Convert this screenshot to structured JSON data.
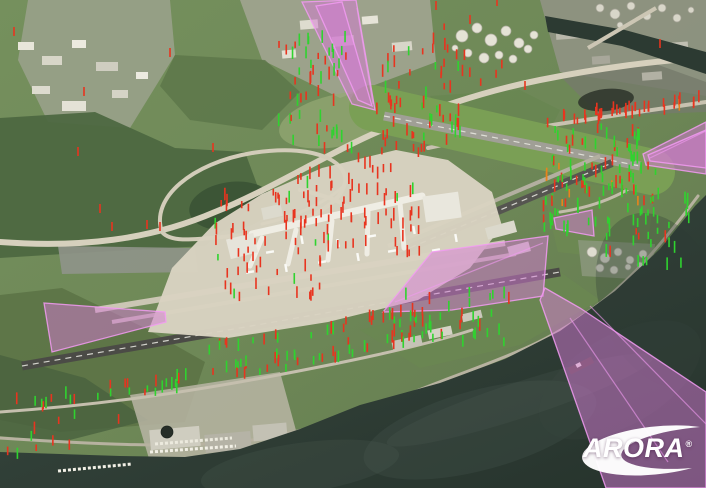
{
  "logo": {
    "text": "ARORA",
    "registered": "®"
  },
  "colors": {
    "surface_fill": "#d67ad6",
    "surface_edge": "#f29bf2",
    "marker_red": "#e8341f",
    "marker_green": "#2fd32f",
    "marker_orange": "#e8831c",
    "water_deep": "#26332c",
    "water_shallow": "#3a4a41",
    "land_green": "#6e8857",
    "runway_dark": "#4b4b46",
    "taxiway_light": "#cbc6b4",
    "apron_tan": "#d9d3c1",
    "logo_white": "#ffffff"
  },
  "map": {
    "patches": [
      {
        "pts": "28,0 170,0 175,55 130,128 48,122 18,60",
        "f": "#99a189",
        "o": 0.9
      },
      {
        "pts": "240,0 430,0 436,62 340,98 262,60",
        "f": "#a3a694",
        "o": 0.85
      },
      {
        "pts": "540,0 706,0 706,96 560,72",
        "f": "#8e9282",
        "o": 0.95
      },
      {
        "pts": "0,118 95,112 175,148 245,152 262,198 205,246 95,252 0,258",
        "f": "#4d6841",
        "o": 0.95
      },
      {
        "pts": "175,55 265,60 300,92 262,130 190,120 160,86",
        "f": "#5b7549",
        "o": 0.8
      },
      {
        "el": [
          231,
          206,
          42,
          24,
          -8
        ],
        "f": "#3a5335",
        "o": 0.9
      },
      {
        "el": [
          340,
          120,
          62,
          26,
          -12
        ],
        "f": "#96a975",
        "o": 0.7
      },
      {
        "pts": "0,295 62,288 145,328 205,362 185,422 60,432 0,420",
        "f": "#5c7346",
        "o": 0.9
      },
      {
        "pts": "0,355 85,378 148,420 62,442 0,436",
        "f": "#49613e",
        "o": 0.8
      },
      {
        "pts": "540,178 655,192 645,262 558,252",
        "f": "#6d8a52",
        "o": 0.75
      },
      {
        "pts": "430,96 520,90 560,110 540,150 460,150",
        "f": "#66854e",
        "o": 0.6
      },
      {
        "pts": "560,76 650,62 706,82 706,112 600,116",
        "f": "#757a6b",
        "o": 0.8
      },
      {
        "el": [
          606,
          100,
          28,
          11,
          -6
        ],
        "f": "#31372e",
        "o": 0.9
      },
      {
        "pts": "360,330 480,300 560,272 600,300 520,345 420,368",
        "f": "#6a8751",
        "o": 0.8
      },
      {
        "pts": "58,246 195,248 198,272 62,274",
        "f": "#8f948a",
        "o": 0.9
      },
      {
        "pts": "130,395 280,372 300,445 150,462",
        "f": "#b9b5a4",
        "o": 0.85
      },
      {
        "pts": "578,240 655,244 652,280 582,276",
        "f": "#8d9880",
        "o": 0.8
      }
    ],
    "roads": [
      {
        "d": "M0,242 C80,248 150,240 215,212 C270,190 330,152 382,130 C430,110 480,92 540,80 C600,68 660,60 706,58",
        "w": 6,
        "c": "#d6d0bd"
      },
      {
        "d": "M162,232 C150,198 192,163 252,153 C322,142 352,166 344,186 C336,212 282,232 222,237 C190,240 170,242 162,232",
        "w": 4,
        "c": "#d2ccb9"
      },
      {
        "d": "M344,186 C326,202 298,216 262,224",
        "w": 3,
        "c": "#cfc9b6"
      },
      {
        "d": "M428,148 C520,128 600,118 706,102",
        "w": 4,
        "c": "#c8c2b0"
      },
      {
        "d": "M0,438 C90,444 185,449 252,440 C330,428 382,404 442,381 C505,357 545,344 588,312 C628,284 662,244 698,196",
        "w": 3,
        "c": "#b7b2a0"
      },
      {
        "d": "M0,412 C100,405 180,393 262,378 C342,363 420,347 472,330",
        "w": 3,
        "c": "#c5bfae"
      },
      {
        "d": "M560,212 C600,206 636,190 650,170 C660,153 646,144 626,149",
        "w": 3,
        "c": "#c2bcaa"
      },
      {
        "d": "M300,190 C330,196 352,206 364,218",
        "w": 4,
        "c": "#d2ccb9"
      }
    ],
    "runways": [
      {
        "x1": 372,
        "y1": 108,
        "x2": 652,
        "y2": 172,
        "w": 46,
        "c": "#7a9f55",
        "cap": "round"
      },
      {
        "x1": 384,
        "y1": 116,
        "x2": 640,
        "y2": 166,
        "w": 9,
        "c": "#a09f96",
        "dash": true
      },
      {
        "x1": 388,
        "y1": 246,
        "x2": 600,
        "y2": 156,
        "w": 4,
        "c": "#b3afa0"
      },
      {
        "x1": 400,
        "y1": 252,
        "x2": 612,
        "y2": 163,
        "w": 8,
        "c": "#555550",
        "dash": true
      },
      {
        "x1": 95,
        "y1": 310,
        "x2": 505,
        "y2": 243,
        "w": 6,
        "c": "#cbc6b4"
      },
      {
        "x1": 112,
        "y1": 322,
        "x2": 516,
        "y2": 254,
        "w": 4,
        "c": "#c1bcaa"
      },
      {
        "x1": 22,
        "y1": 366,
        "x2": 560,
        "y2": 272,
        "w": 9,
        "c": "#4b4b46",
        "dash": true
      }
    ],
    "apron": {
      "pts": "148,332 172,268 214,224 262,194 322,168 396,150 448,160 492,192 502,226 470,268 418,300 328,322 228,338",
      "f": "#d9d3c1",
      "o": 0.97
    },
    "concourses": [
      {
        "d": "M252,234 L422,196",
        "w": 7,
        "c": "#efede4"
      },
      {
        "d": "M262,238 L250,266",
        "w": 5,
        "c": "#efede4"
      },
      {
        "d": "M296,230 L288,264",
        "w": 5,
        "c": "#efede4"
      },
      {
        "d": "M332,221 L328,260",
        "w": 5,
        "c": "#efede4"
      },
      {
        "d": "M368,211 L367,254",
        "w": 5,
        "c": "#efede4"
      },
      {
        "d": "M400,203 L404,248",
        "w": 5,
        "c": "#efede4"
      }
    ],
    "buildings": [
      [
        18,
        42,
        16,
        8,
        0,
        "#e8e6da"
      ],
      [
        42,
        56,
        20,
        9,
        0,
        "#d8d6c8"
      ],
      [
        72,
        40,
        14,
        8,
        0,
        "#eceadf"
      ],
      [
        96,
        62,
        22,
        9,
        0,
        "#cfcdc0"
      ],
      [
        32,
        86,
        18,
        8,
        0,
        "#dddbcf"
      ],
      [
        62,
        101,
        24,
        10,
        0,
        "#e4e2d6"
      ],
      [
        112,
        90,
        16,
        8,
        0,
        "#d5d3c6"
      ],
      [
        136,
        72,
        12,
        7,
        0,
        "#eceae0"
      ],
      [
        300,
        20,
        18,
        9,
        -5,
        "#dedccf"
      ],
      [
        332,
        36,
        22,
        10,
        -5,
        "#cfcdc0"
      ],
      [
        362,
        16,
        16,
        8,
        -5,
        "#e6e4d8"
      ],
      [
        392,
        42,
        20,
        9,
        -5,
        "#d8d6c9"
      ],
      [
        282,
        50,
        14,
        8,
        -5,
        "#e2e0d3"
      ],
      [
        556,
        30,
        24,
        9,
        -4,
        "#b9b8ab"
      ],
      [
        592,
        56,
        18,
        8,
        -4,
        "#a8a79a"
      ],
      [
        642,
        72,
        20,
        8,
        -4,
        "#b2b1a4"
      ],
      [
        672,
        42,
        16,
        8,
        -4,
        "#c0bfb2"
      ],
      [
        150,
        428,
        50,
        20,
        -5,
        "#cfcdc0"
      ],
      [
        205,
        433,
        46,
        18,
        -5,
        "#b5b3a6"
      ],
      [
        253,
        424,
        34,
        16,
        -5,
        "#c3c1b4"
      ],
      [
        392,
        338,
        30,
        10,
        -12,
        "#c5c3b6"
      ],
      [
        428,
        328,
        24,
        9,
        -12,
        "#d5d3c6"
      ],
      [
        462,
        312,
        20,
        8,
        -14,
        "#cac8bb"
      ],
      [
        486,
        224,
        30,
        12,
        -15,
        "#dbd9cc"
      ],
      [
        508,
        244,
        22,
        10,
        -15,
        "#cfcdc0"
      ],
      [
        424,
        194,
        36,
        26,
        -8,
        "#e9e7dd"
      ],
      [
        228,
        236,
        28,
        20,
        -14,
        "#e6e4da"
      ],
      [
        262,
        206,
        20,
        12,
        -12,
        "#dcdacd"
      ]
    ],
    "tanks": [
      {
        "f": "#e5e3d6",
        "s": "#b0aea0",
        "circles": [
          [
            462,
            36,
            6
          ],
          [
            477,
            28,
            5
          ],
          [
            491,
            40,
            6
          ],
          [
            506,
            31,
            5
          ],
          [
            519,
            43,
            5
          ],
          [
            468,
            53,
            4
          ],
          [
            484,
            58,
            5
          ],
          [
            499,
            55,
            4
          ],
          [
            513,
            59,
            4
          ],
          [
            528,
            49,
            4
          ],
          [
            455,
            48,
            3
          ],
          [
            534,
            35,
            4
          ]
        ]
      },
      {
        "f": "#d8d6c9",
        "s": "#a5a396",
        "circles": [
          [
            600,
            8,
            4
          ],
          [
            615,
            14,
            5
          ],
          [
            631,
            6,
            4
          ],
          [
            647,
            16,
            4
          ],
          [
            662,
            8,
            4
          ],
          [
            677,
            18,
            4
          ],
          [
            691,
            10,
            3
          ],
          [
            620,
            25,
            3
          ]
        ]
      },
      {
        "f": "#dfddd0",
        "s": "#a8a699",
        "circles": [
          [
            592,
            252,
            5
          ],
          [
            605,
            258,
            5
          ],
          [
            618,
            252,
            4
          ],
          [
            630,
            260,
            4
          ],
          [
            643,
            254,
            4
          ],
          [
            600,
            268,
            4
          ],
          [
            614,
            270,
            4
          ],
          [
            628,
            267,
            3
          ],
          [
            640,
            265,
            3
          ]
        ]
      },
      {
        "f": "#262e28",
        "s": "#1c241f",
        "circles": [
          [
            167,
            432,
            6
          ]
        ]
      }
    ],
    "water": {
      "pts": "0,452 120,456 185,457 240,449 300,429 360,405 440,383 505,359 560,331 615,291 660,249 695,206 706,195 706,488 0,488",
      "swirls": [
        [
          480,
          430,
          120,
          40,
          -15,
          "#4d5c52",
          0.25
        ],
        [
          300,
          468,
          100,
          25,
          -8,
          "#55645b",
          0.2
        ],
        [
          620,
          380,
          90,
          45,
          -30,
          "#36443c",
          0.35
        ],
        [
          520,
          400,
          140,
          18,
          -18,
          "#5e6d63",
          0.15
        ],
        [
          660,
          300,
          60,
          90,
          -20,
          "#2e3b34",
          0.3
        ]
      ],
      "ship": {
        "hull": [
          568,
          362,
          26,
          7,
          -27,
          "#473f35"
        ],
        "deck": [
          576,
          363,
          5,
          4,
          -27,
          "#e8e6da"
        ]
      }
    },
    "river": {
      "pts": "545,16 625,30 706,52 706,74 622,46 548,32",
      "f": "#2c3a32"
    },
    "roads_over": [
      {
        "d": "M588,48 L656,8",
        "w": 4,
        "c": "#ccc6b4"
      },
      {
        "d": "M150,452 L236,446",
        "w": 3,
        "c": "#f2f0e6",
        "dash": "3,2"
      },
      {
        "d": "M58,471 L132,464",
        "w": 3,
        "c": "#f2f0e6",
        "dash": "3,2"
      },
      {
        "d": "M155,444 L232,438",
        "w": 3,
        "c": "#eceade",
        "dash": "3,2"
      }
    ],
    "aircraft": [
      [
        250,
        272,
        -10
      ],
      [
        286,
        268,
        -100
      ],
      [
        322,
        262,
        -10
      ],
      [
        358,
        257,
        -100
      ],
      [
        392,
        251,
        -10
      ],
      [
        302,
        240,
        -100
      ],
      [
        270,
        252,
        -10
      ],
      [
        338,
        243,
        -100
      ],
      [
        372,
        236,
        -10
      ],
      [
        414,
        230,
        -100
      ],
      [
        436,
        250,
        -10
      ],
      [
        456,
        238,
        -100
      ]
    ],
    "surfaces": [
      {
        "pts": "302,2 356,0 375,110 352,104"
      },
      {
        "pts": "316,6 342,2 372,106 358,100"
      },
      {
        "pts": "706,122 706,174 646,165 643,154"
      },
      {
        "pts": "706,130 706,168 650,161 648,155"
      },
      {
        "pts": "554,218 592,210 594,236 556,229"
      },
      {
        "pts": "383,312 432,252 548,236 543,296 452,310"
      },
      {
        "pts": "545,288 580,308 706,392 706,488 606,488 540,300"
      },
      {
        "pts": "44,303 165,312 166,322 52,352"
      }
    ],
    "surface_folds": [
      [
        395,
        302,
        543,
        243
      ],
      [
        570,
        318,
        668,
        462
      ],
      [
        590,
        306,
        706,
        424
      ],
      [
        357,
        8,
        373,
        104
      ],
      [
        650,
        158,
        706,
        131
      ]
    ],
    "marker_clusters": [
      {
        "id": "terminal-west",
        "x": 215,
        "y": 190,
        "w": 115,
        "h": 112,
        "n": 65,
        "red": 0.93,
        "green": 0.07,
        "orange": 0,
        "seed": 11
      },
      {
        "id": "terminal-east",
        "x": 300,
        "y": 150,
        "w": 120,
        "h": 110,
        "n": 70,
        "red": 0.9,
        "green": 0.1,
        "orange": 0,
        "seed": 22
      },
      {
        "id": "cargo-city",
        "x": 278,
        "y": 42,
        "w": 70,
        "h": 105,
        "n": 48,
        "red": 0.45,
        "green": 0.55,
        "orange": 0,
        "seed": 33
      },
      {
        "id": "approach-north-flank",
        "x": 375,
        "y": 50,
        "w": 85,
        "h": 105,
        "n": 55,
        "red": 0.72,
        "green": 0.28,
        "orange": 0,
        "seed": 44
      },
      {
        "id": "rail-line",
        "x1": 545,
        "y1": 126,
        "x2": 700,
        "y2": 106,
        "spread": 5,
        "n": 38,
        "red": 0.88,
        "green": 0,
        "orange": 0.12,
        "seed": 55
      },
      {
        "id": "east-mixed",
        "x": 552,
        "y": 128,
        "w": 95,
        "h": 68,
        "n": 45,
        "red": 0.5,
        "green": 0.5,
        "orange": 0,
        "seed": 66
      },
      {
        "id": "infield-east",
        "x": 538,
        "y": 168,
        "w": 120,
        "h": 38,
        "n": 32,
        "red": 0.38,
        "green": 0.42,
        "orange": 0.2,
        "seed": 77
      },
      {
        "id": "shore-green",
        "x": 595,
        "y": 198,
        "w": 95,
        "h": 72,
        "n": 40,
        "red": 0.18,
        "green": 0.82,
        "orange": 0,
        "seed": 88
      },
      {
        "id": "shore-green-north",
        "x": 624,
        "y": 130,
        "w": 16,
        "h": 36,
        "n": 9,
        "red": 0.1,
        "green": 0.9,
        "orange": 0,
        "seed": 99
      },
      {
        "id": "midfield-green",
        "x": 395,
        "y": 295,
        "w": 115,
        "h": 52,
        "n": 36,
        "red": 0.3,
        "green": 0.7,
        "orange": 0,
        "seed": 111
      },
      {
        "id": "south-road-east",
        "x1": 195,
        "y1": 382,
        "x2": 465,
        "y2": 330,
        "spread": 8,
        "n": 44,
        "red": 0.5,
        "green": 0.5,
        "orange": 0,
        "seed": 122
      },
      {
        "id": "south-road-west",
        "x1": 2,
        "y1": 410,
        "x2": 190,
        "y2": 386,
        "spread": 7,
        "n": 30,
        "red": 0.45,
        "green": 0.55,
        "orange": 0,
        "seed": 133
      },
      {
        "id": "taxiway-line",
        "x1": 205,
        "y1": 352,
        "x2": 420,
        "y2": 316,
        "spread": 5,
        "n": 26,
        "red": 0.55,
        "green": 0.45,
        "orange": 0,
        "seed": 144
      },
      {
        "id": "west-sparse",
        "x": 0,
        "y": 415,
        "w": 130,
        "h": 45,
        "n": 10,
        "red": 0.5,
        "green": 0.5,
        "orange": 0,
        "seed": 155
      },
      {
        "id": "north-sparse-reds",
        "x": 430,
        "y": 28,
        "w": 80,
        "h": 60,
        "n": 12,
        "red": 0.85,
        "green": 0.15,
        "orange": 0,
        "seed": 166
      },
      {
        "id": "east-road-reds",
        "x": 535,
        "y": 202,
        "w": 55,
        "h": 40,
        "n": 18,
        "red": 0.6,
        "green": 0.4,
        "orange": 0,
        "seed": 177
      }
    ],
    "marker_singles": [
      {
        "x": 14,
        "y": 36
      },
      {
        "x": 84,
        "y": 96
      },
      {
        "x": 170,
        "y": 57
      },
      {
        "x": 213,
        "y": 152
      },
      {
        "x": 78,
        "y": 156
      },
      {
        "x": 100,
        "y": 213
      },
      {
        "x": 147,
        "y": 229
      },
      {
        "x": 160,
        "y": 231
      },
      {
        "x": 112,
        "y": 231
      },
      {
        "x": 298,
        "y": 184
      },
      {
        "x": 436,
        "y": 10
      },
      {
        "x": 470,
        "y": 24
      },
      {
        "x": 497,
        "y": 6
      },
      {
        "x": 660,
        "y": 48
      },
      {
        "x": 525,
        "y": 90
      }
    ]
  }
}
